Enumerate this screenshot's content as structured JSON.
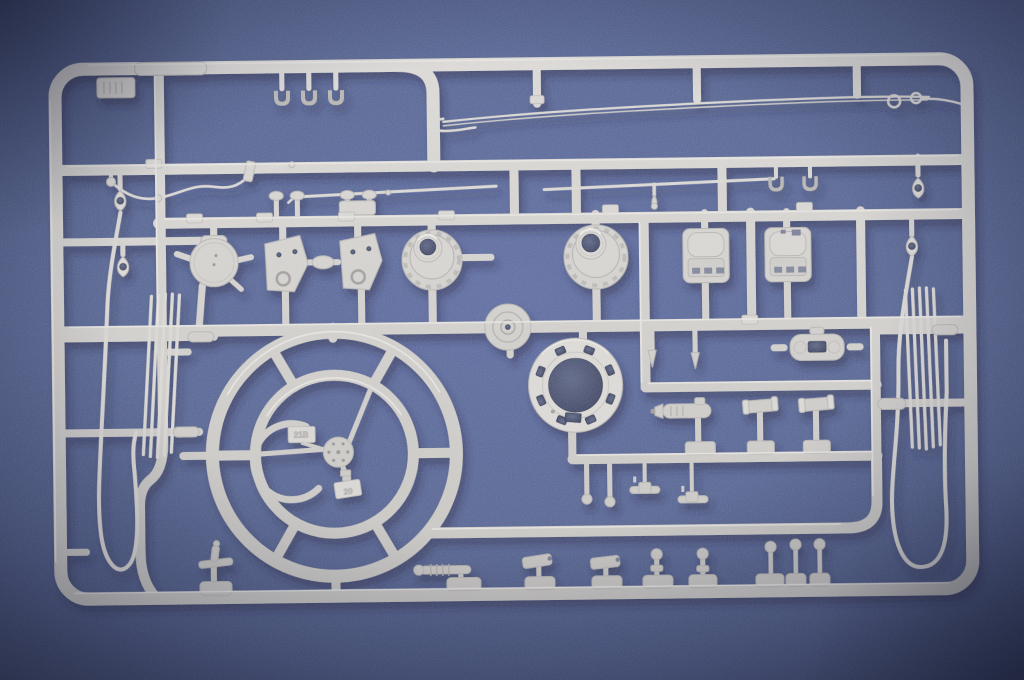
{
  "scene": {
    "description": "Close-up photograph of a light grey injection-moulded plastic model kit sprue with unassembled parts, lying on a blue textured paper background",
    "background": {
      "color_mid": "#54639a",
      "color_edge": "#3e4b79",
      "color_corner": "#2c3557"
    },
    "plastic": {
      "base": "#cfccc7",
      "light": "#dad7d2",
      "dark": "#c3c0bb",
      "highlight": "#ece9e4",
      "edge": "#b3b0ac",
      "hole": "#2b3150",
      "cast_shadow": "#1c2344"
    },
    "embossed": {
      "wheel_tab_upper": "21B",
      "wheel_tab_lower": "20"
    },
    "parts_inventory": [
      {
        "name": "sprue-frame",
        "qty": 1
      },
      {
        "name": "steering-wheel-with-hub-and-horn-ring",
        "qty": 1
      },
      {
        "name": "turret-race-ring",
        "qty": 1
      },
      {
        "name": "drum-hub",
        "qty": 2
      },
      {
        "name": "side-plate",
        "qty": 2
      },
      {
        "name": "round-hatch-disc",
        "qty": 1
      },
      {
        "name": "seat",
        "qty": 2
      },
      {
        "name": "tow-cable-with-eyelets",
        "qty": 2
      },
      {
        "name": "cleaning-rod-bundle",
        "qty": 2
      },
      {
        "name": "long-tow-wire",
        "qty": 1
      },
      {
        "name": "antenna-wire",
        "qty": 1
      },
      {
        "name": "thin-rod",
        "qty": 2
      },
      {
        "name": "c-clamp",
        "qty": 5
      },
      {
        "name": "mushroom-peg",
        "qty": 4
      },
      {
        "name": "periscope",
        "qty": 2
      },
      {
        "name": "ribbed-rod",
        "qty": 1
      },
      {
        "name": "ball-top-pin",
        "qty": 5
      },
      {
        "name": "t-handle",
        "qty": 2
      },
      {
        "name": "extinguisher-cylinder",
        "qty": 1
      },
      {
        "name": "tool-bracket",
        "qty": 1
      },
      {
        "name": "tapered-pin",
        "qty": 2
      },
      {
        "name": "cross-fitting",
        "qty": 2
      },
      {
        "name": "hand-lever",
        "qty": 1
      },
      {
        "name": "junction-disc",
        "qty": 1
      }
    ]
  }
}
